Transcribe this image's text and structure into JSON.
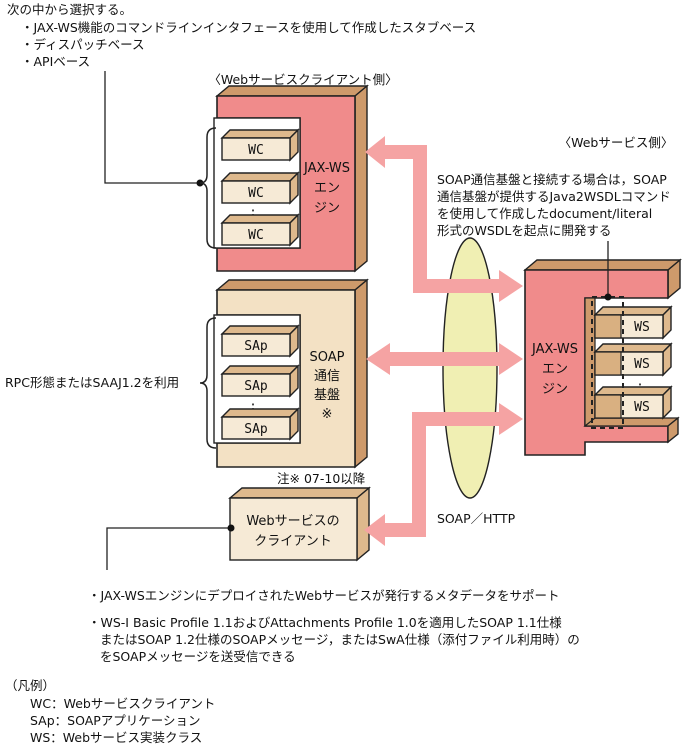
{
  "intro": {
    "heading": "次の中から選択する。",
    "bullets": [
      "・JAX-WS機能のコマンドラインインタフェースを使用して作成したスタブベース",
      "・ディスパッチベース",
      "・APIベース"
    ]
  },
  "client": {
    "heading": "〈Webサービスクライアント側〉",
    "engine_lines": [
      "JAX-WS",
      "エン",
      "ジン"
    ],
    "wc_labels": [
      "WC",
      "WC",
      "WC"
    ],
    "soap_lines": [
      "SOAP",
      "通信",
      "基盤",
      "※"
    ],
    "sap_labels": [
      "SAp",
      "SAp",
      "SAp"
    ],
    "rpc_note": "RPC形態またはSAAJ1.2を利用",
    "version_note": "注※ 07-10以降",
    "ws_client_lines": [
      "Webサービスの",
      "クライアント"
    ]
  },
  "service": {
    "heading": "〈Webサービス側〉",
    "annotation_lines": [
      "SOAP通信基盤と接続する場合は，SOAP",
      "通信基盤が提供するJava2WSDLコマンド",
      "を使用して作成したdocument/literal",
      "形式のWSDLを起点に開発する"
    ],
    "engine_lines": [
      "JAX-WS",
      "エン",
      "ジン"
    ],
    "ws_labels": [
      "WS",
      "WS",
      "WS"
    ]
  },
  "glyphs": {
    "ellipsis": ":"
  },
  "network": {
    "protocol": "SOAP／HTTP"
  },
  "footer": {
    "lines": [
      "・JAX-WSエンジンにデプロイされたWebサービスが発行するメタデータをサポート",
      "・WS-I Basic Profile 1.1およびAttachments Profile 1.0を適用したSOAP 1.1仕様",
      "またはSOAP 1.2仕様のSOAPメッセージ，またはSwA仕様（添付ファイル利用時）の",
      "をSOAPメッセージを送受信できる"
    ]
  },
  "legend": {
    "heading": "（凡例）",
    "items": [
      "WC：Webサービスクライアント",
      "SAp：SOAPアプリケーション",
      "WS：Webサービス実装クラス"
    ]
  },
  "colors": {
    "engine_pink": "#F08B8B",
    "arrow_pink": "#F5A3A3",
    "box_side_tan": "#CE9A6B",
    "small_box_tan": "#DEB98D",
    "cream_face": "#F6EAD6",
    "soap_face": "#F3E1C4",
    "network_ellipse": "#F0EFB3",
    "outline": "#222222"
  }
}
